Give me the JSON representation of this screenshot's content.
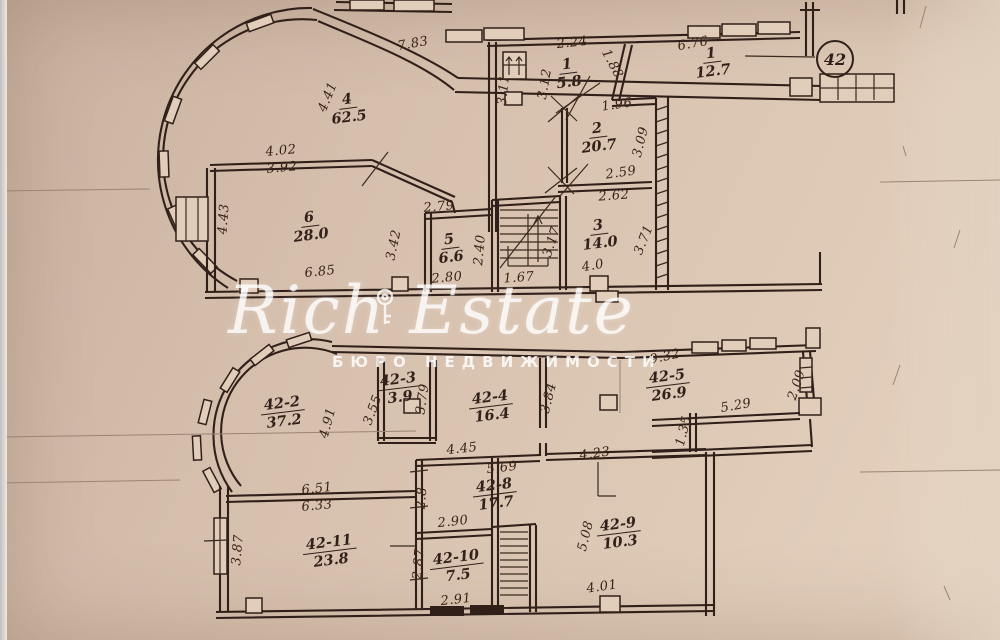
{
  "watermark": {
    "title": "Rich Estate",
    "subtitle": "БЮРО НЕДВИЖИМОСТИ"
  },
  "apartment_number": "42",
  "colors": {
    "paper": "#d6bfad",
    "ink": "#31201a",
    "watermark": "#ffffff"
  },
  "plans": [
    {
      "id": "upper-floor",
      "rooms": [
        {
          "num": "4",
          "area": "62.5",
          "x": 348,
          "y": 108
        },
        {
          "num": "1",
          "area": "5.8",
          "x": 568,
          "y": 73
        },
        {
          "num": "1",
          "area": "12.7",
          "x": 712,
          "y": 62
        },
        {
          "num": "2",
          "area": "20.7",
          "x": 598,
          "y": 137
        },
        {
          "num": "6",
          "area": "28.0",
          "x": 310,
          "y": 226
        },
        {
          "num": "5",
          "area": "6.6",
          "x": 450,
          "y": 248
        },
        {
          "num": "3",
          "area": "14.0",
          "x": 599,
          "y": 234
        }
      ],
      "dims": [
        {
          "t": "7.83",
          "x": 413,
          "y": 44,
          "r": -10
        },
        {
          "t": "2.24",
          "x": 572,
          "y": 43,
          "r": -6
        },
        {
          "t": "6.76",
          "x": 693,
          "y": 44,
          "r": -10
        },
        {
          "t": "1.88",
          "x": 612,
          "y": 64,
          "r": 62
        },
        {
          "t": "3.11",
          "x": 504,
          "y": 90,
          "r": -84
        },
        {
          "t": "3.12",
          "x": 545,
          "y": 84,
          "r": -80
        },
        {
          "t": "4.41",
          "x": 328,
          "y": 97,
          "r": -68
        },
        {
          "t": "1.96",
          "x": 617,
          "y": 105,
          "r": -8
        },
        {
          "t": "4.02",
          "x": 281,
          "y": 151,
          "r": -5
        },
        {
          "t": "3.92",
          "x": 282,
          "y": 168,
          "r": -5
        },
        {
          "t": "3.09",
          "x": 641,
          "y": 142,
          "r": -76
        },
        {
          "t": "2.59",
          "x": 621,
          "y": 173,
          "r": -8
        },
        {
          "t": "2.62",
          "x": 614,
          "y": 196,
          "r": -4
        },
        {
          "t": "4.43",
          "x": 224,
          "y": 219,
          "r": -86
        },
        {
          "t": "2.79",
          "x": 439,
          "y": 207,
          "r": -5
        },
        {
          "t": "2.40",
          "x": 480,
          "y": 250,
          "r": -85
        },
        {
          "t": "3.17",
          "x": 552,
          "y": 242,
          "r": -72
        },
        {
          "t": "3.42",
          "x": 394,
          "y": 245,
          "r": -78
        },
        {
          "t": "3.71",
          "x": 644,
          "y": 240,
          "r": -68
        },
        {
          "t": "6.85",
          "x": 320,
          "y": 272,
          "r": -6
        },
        {
          "t": "2.80",
          "x": 447,
          "y": 278,
          "r": -5
        },
        {
          "t": "1.67",
          "x": 519,
          "y": 278,
          "r": -4
        },
        {
          "t": "4.0",
          "x": 593,
          "y": 266,
          "r": -10
        }
      ]
    },
    {
      "id": "lower-floor",
      "rooms": [
        {
          "num": "42-2",
          "area": "37.2",
          "x": 283,
          "y": 412
        },
        {
          "num": "42-3",
          "area": "3.9",
          "x": 399,
          "y": 388
        },
        {
          "num": "42-4",
          "area": "16.4",
          "x": 491,
          "y": 406
        },
        {
          "num": "42-5",
          "area": "26.9",
          "x": 668,
          "y": 385
        },
        {
          "num": "42-8",
          "area": "17.7",
          "x": 495,
          "y": 494
        },
        {
          "num": "42-9",
          "area": "10.3",
          "x": 619,
          "y": 533
        },
        {
          "num": "42-11",
          "area": "23.8",
          "x": 330,
          "y": 551
        },
        {
          "num": "42-10",
          "area": "7.5",
          "x": 457,
          "y": 566
        }
      ],
      "dims": [
        {
          "t": "9.32",
          "x": 665,
          "y": 357,
          "r": -12
        },
        {
          "t": "2.09",
          "x": 797,
          "y": 385,
          "r": -72
        },
        {
          "t": "5.29",
          "x": 736,
          "y": 406,
          "r": -10
        },
        {
          "t": "4.91",
          "x": 328,
          "y": 423,
          "r": -75
        },
        {
          "t": "3.55",
          "x": 373,
          "y": 410,
          "r": -70
        },
        {
          "t": "3.79",
          "x": 423,
          "y": 399,
          "r": -82
        },
        {
          "t": "3.84",
          "x": 549,
          "y": 398,
          "r": -76
        },
        {
          "t": "4.45",
          "x": 462,
          "y": 449,
          "r": -6
        },
        {
          "t": "5.69",
          "x": 502,
          "y": 468,
          "r": -6
        },
        {
          "t": "4.23",
          "x": 595,
          "y": 454,
          "r": -8
        },
        {
          "t": "1.35",
          "x": 684,
          "y": 431,
          "r": -76
        },
        {
          "t": "6.51",
          "x": 317,
          "y": 489,
          "r": -6
        },
        {
          "t": "6.33",
          "x": 317,
          "y": 506,
          "r": -5
        },
        {
          "t": "2.8",
          "x": 422,
          "y": 498,
          "r": -85
        },
        {
          "t": "2.90",
          "x": 453,
          "y": 522,
          "r": -6
        },
        {
          "t": "5.08",
          "x": 586,
          "y": 536,
          "r": -76
        },
        {
          "t": "3.87",
          "x": 238,
          "y": 550,
          "r": -85
        },
        {
          "t": "2.87",
          "x": 419,
          "y": 564,
          "r": -85
        },
        {
          "t": "2.91",
          "x": 456,
          "y": 600,
          "r": -6
        },
        {
          "t": "4.01",
          "x": 602,
          "y": 587,
          "r": -8
        }
      ]
    }
  ]
}
